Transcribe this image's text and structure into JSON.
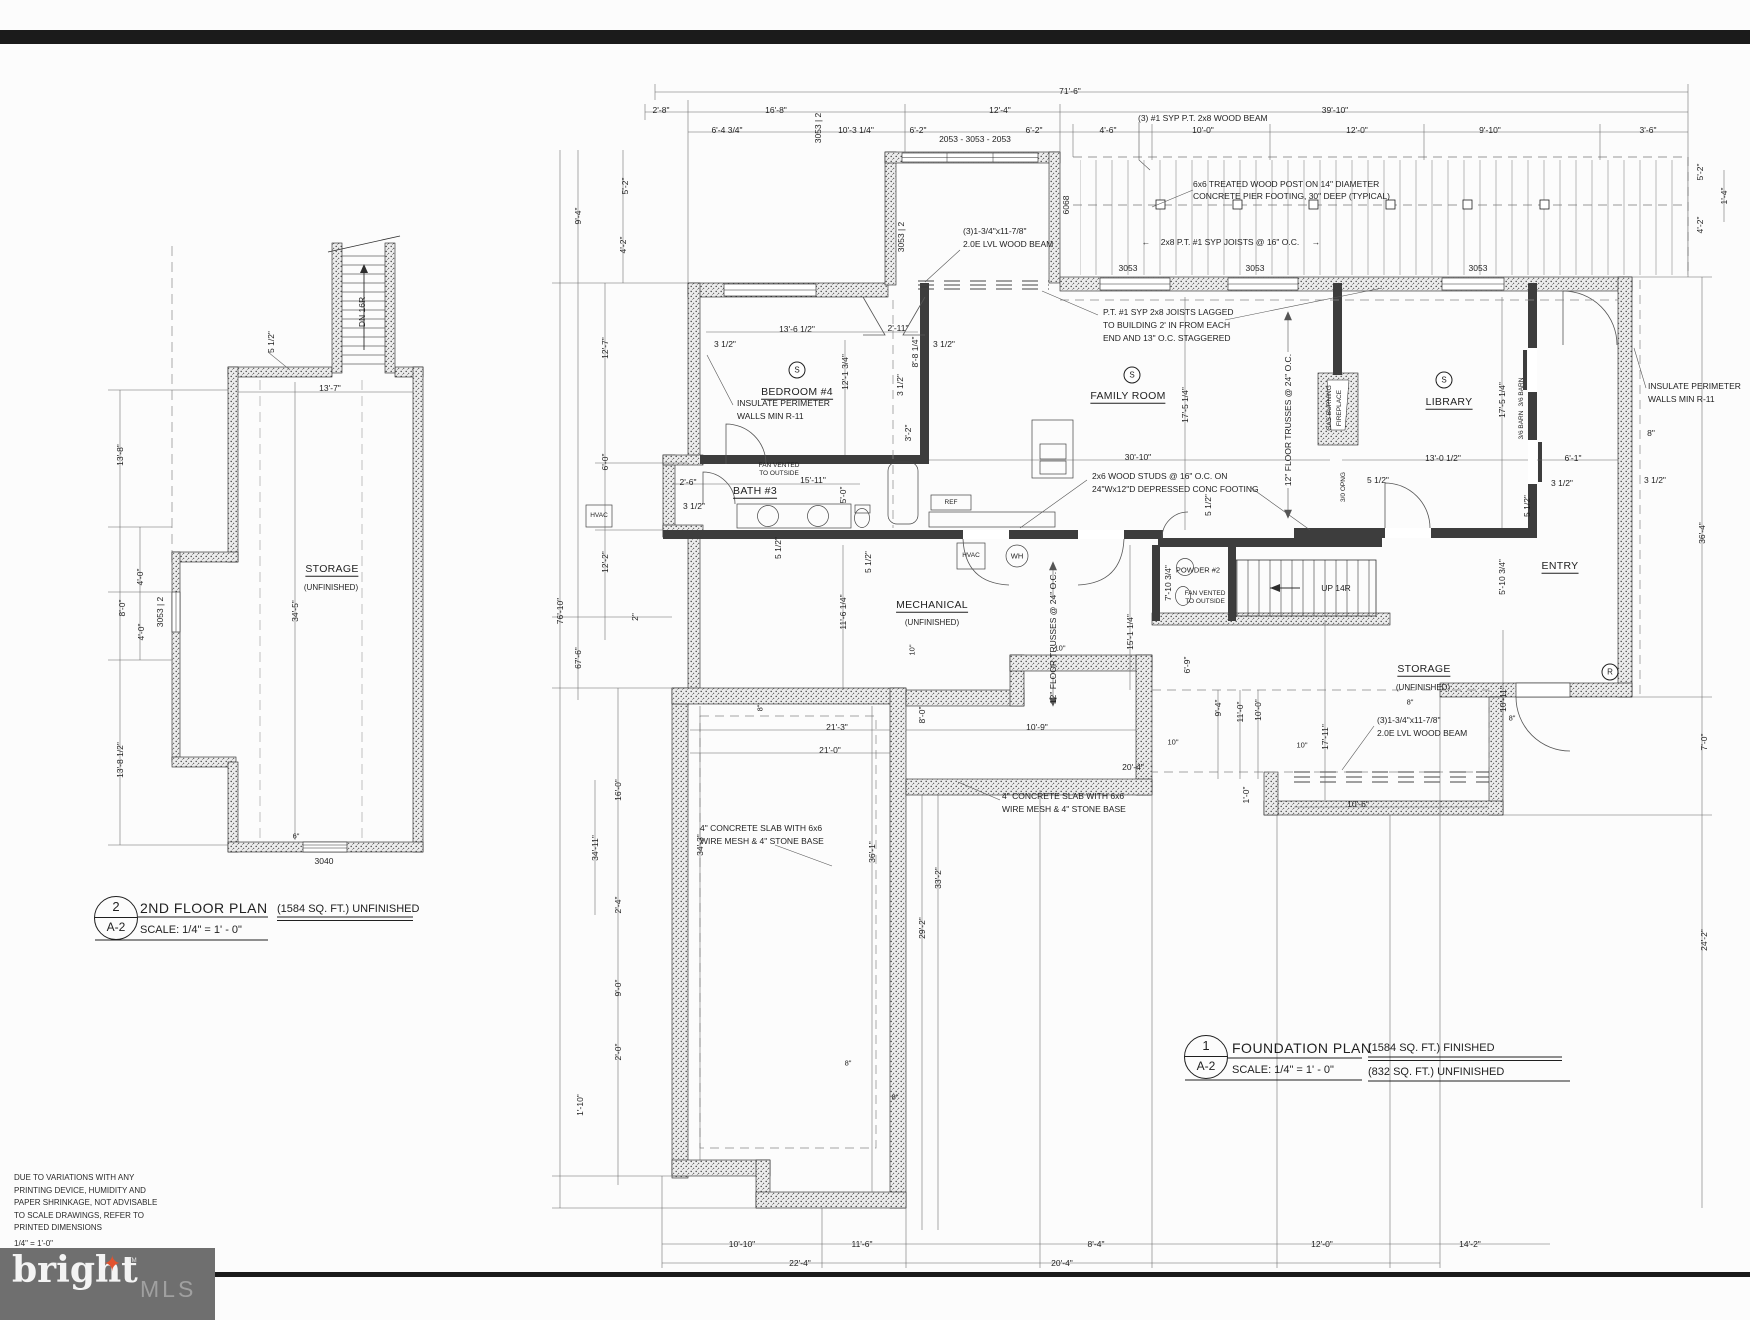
{
  "sheet": {
    "disclaimer": [
      "DUE TO VARIATIONS WITH ANY",
      "PRINTING DEVICE, HUMIDITY AND",
      "PAPER SHRINKAGE, NOT ADVISABLE",
      "TO SCALE DRAWINGS, REFER TO",
      "PRINTED DIMENSIONS"
    ],
    "scale_note": "1/4\" = 1'-0\""
  },
  "logo": {
    "brand": "bright",
    "tm": "TM",
    "suffix": "MLS",
    "star": "✦",
    "box_color": "#6f6f6f",
    "star_color": "#e2522e"
  },
  "second_floor": {
    "title": {
      "num": "2",
      "sheet": "A-2",
      "name": "2ND FLOOR PLAN",
      "scale": "SCALE:  1/4\" =  1' -  0\"",
      "area": "(1584 SQ. FT.) UNFINISHED"
    },
    "room": {
      "name": "STORAGE",
      "sub": "(UNFINISHED)"
    },
    "stair_label": "DN 16R",
    "windows": {
      "left": "3053 | 2",
      "bottom": "3040"
    },
    "dims": [
      "5 1/2\"",
      "13'-7\"",
      "13'-8\"",
      "34'-5\"",
      "8'-0\"",
      "4'-0\"",
      "4'-0\"",
      "13'-8 1/2\"",
      "6\""
    ]
  },
  "foundation": {
    "title": {
      "num": "1",
      "sheet": "A-2",
      "name": "FOUNDATION PLAN",
      "scale": "SCALE: 1/4\" =  1' -  0\"",
      "area1": "(1584 SQ. FT.) FINISHED",
      "area2": "(832 SQ. FT.) UNFINISHED"
    },
    "rooms": {
      "bedroom": "BEDROOM #4",
      "bath": "BATH #3",
      "family": "FAMILY ROOM",
      "library": "LIBRARY",
      "mechanical": "MECHANICAL",
      "mechanical_sub": "(UNFINISHED)",
      "powder": "POWDER #2",
      "storage": "STORAGE",
      "storage_sub": "(UNFINISHED)",
      "entry": "ENTRY"
    },
    "stair_label": "UP 14R",
    "symbols": {
      "smoke": "S",
      "return": "R"
    },
    "equipment": {
      "hvac": "HVAC",
      "wh": "WH",
      "ref": "REF"
    },
    "windows": {
      "triplet": "2053 - 3053 - 2053",
      "single": "3053",
      "pair": "3053 | 2",
      "door": "6068"
    },
    "notes": {
      "beam_top": "(3) #1 SYP P.T. 2x8 WOOD BEAM",
      "post": [
        "6x6 TREATED WOOD POST ON 14\" DIAMETER",
        "CONCRETE PIER FOOTING, 30\" DEEP (TYPICAL)"
      ],
      "deck_joists": "2x8 P.T. #1 SYP JOISTS @ 16\" O.C.",
      "lvl": [
        "(3)1-3/4\"x11-7/8\"",
        "2.0E LVL WOOD BEAM"
      ],
      "lagged": [
        "P.T. #1 SYP 2x8 JOISTS LAGGED",
        "TO BUILDING 2' IN FROM EACH",
        "END AND 13\" O.C. STAGGERED"
      ],
      "insulate": [
        "INSULATE PERIMETER",
        "WALLS MIN R-11"
      ],
      "studs": [
        "2x6 WOOD STUDS @ 16\" O.C. ON",
        "24\"Wx12\"D DEPRESSED CONC FOOTING"
      ],
      "slab": [
        "4\" CONCRETE SLAB WITH 6x6",
        "WIRE MESH & 4\" STONE BASE"
      ],
      "trusses": "12\" FLOOR TRUSSES @ 24\" O.C.",
      "fan": [
        "FAN VENTED",
        "TO OUTSIDE"
      ],
      "fireplace": [
        "GAS BURNING",
        "FIREPLACE"
      ],
      "opng": "3/0 OPNG",
      "barn": "3/6 BARN",
      "arrow_left": "←",
      "arrow_right": "→"
    },
    "dims": {
      "top": [
        "71'-6\"",
        "2'-8\"",
        "16'-8\"",
        "12'-4\"",
        "39'-10\"",
        "6'-4 3/4\"",
        "10'-3 1/4\"",
        "6'-2\"",
        "6'-2\"",
        "4'-6\"",
        "10'-0\"",
        "12'-0\"",
        "9'-10\"",
        "3'-6\""
      ],
      "left": [
        "9'-4\"",
        "5'-2\"",
        "4'-2\"",
        "12'-7\"",
        "6'-0\"",
        "12'-2\"",
        "2\"",
        "76'-10\"",
        "67'-6\"",
        "16'-0\"",
        "34'-11\"",
        "2'-4\"",
        "9'-0\"",
        "2'-0\"",
        "1'-10\""
      ],
      "right": [
        "5'-2\"",
        "4'-2\"",
        "1'-4\"",
        "8\"",
        "3 1/2\"",
        "36'-4\"",
        "7'-0\"",
        "24'-2\""
      ],
      "bottom": [
        "10'-10\"",
        "11'-6\"",
        "8'-4\"",
        "12'-0\"",
        "14'-2\"",
        "22'-4\"",
        "20'-4\""
      ],
      "mid": [
        "3 1/2\"",
        "13'-6 1/2\"",
        "2'-11\"",
        "8'-8 1/4\"",
        "3 1/2\"",
        "3 1/2\"",
        "12'-1 3/4\"",
        "3'-2\"",
        "2'-6\"",
        "3 1/2\"",
        "15'-11\"",
        "5'-0\"",
        "5 1/2\"",
        "30'-10\"",
        "17'-5 1/4\"",
        "17'-5 1/4\"",
        "13'-0 1/2\"",
        "6'-1\"",
        "3 1/2\"",
        "5 1/2\"",
        "5 1/2\"",
        "5'-10 3/4\"",
        "5 1/2\"",
        "7'-10 3/4\"",
        "11'-6 1/4\"",
        "5 1/2\"",
        "15'-1 1/4\"",
        "6'-9\"",
        "17'-11\"",
        "10'-11\"",
        "10'-6\"",
        "20'-4\"",
        "21'-3\"",
        "21'-0\"",
        "10'-9\"",
        "9'-4\"",
        "11'-0\"",
        "10'-0\"",
        "1'-0\"",
        "8'-0\"",
        "34'-3\"",
        "36'-1\"",
        "33'-2\"",
        "29'-2\"",
        "10\"",
        "10\"",
        "10\"",
        "10\"",
        "8\"",
        "8\"",
        "8\"",
        "8\"",
        "8\""
      ]
    }
  }
}
